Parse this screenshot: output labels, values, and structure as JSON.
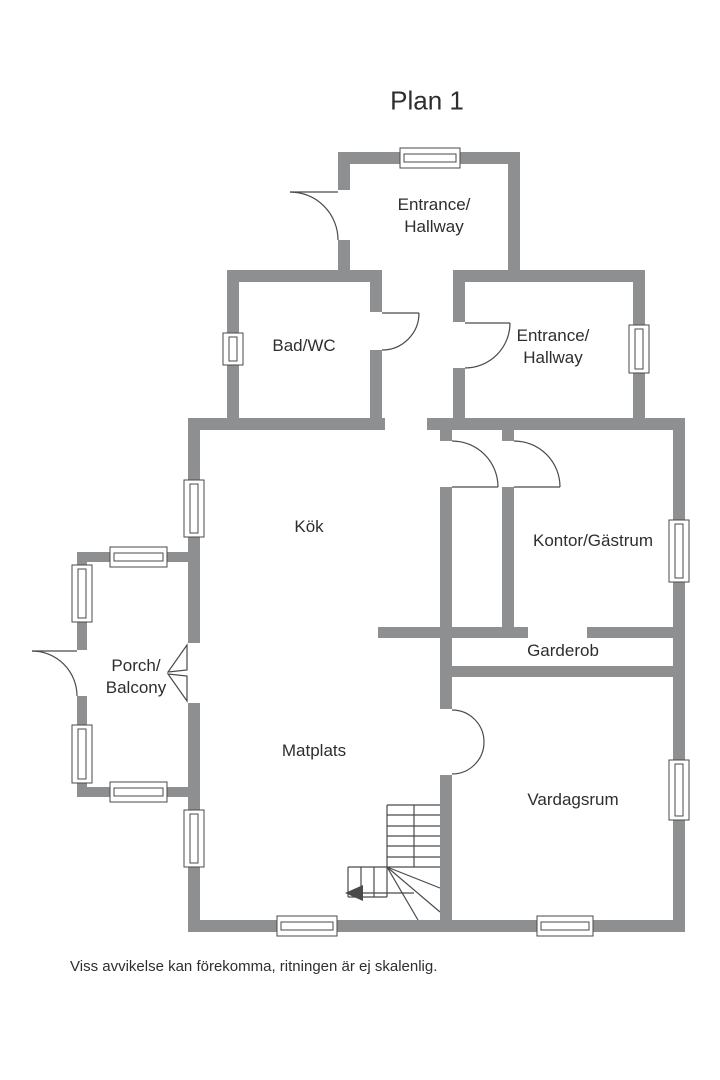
{
  "title": "Plan 1",
  "caption": "Viss avvikelse kan förekomma, ritningen är ej skalenlig.",
  "colors": {
    "wall": "#8d8f91",
    "line": "#4a4a4a",
    "text": "#2e2e2e",
    "background": "#ffffff"
  },
  "rooms": {
    "entrance_top": {
      "line1": "Entrance/",
      "line2": "Hallway"
    },
    "bad_wc": {
      "name": "Bad/WC"
    },
    "entrance_mid": {
      "line1": "Entrance/",
      "line2": "Hallway"
    },
    "kok": {
      "name": "Kök"
    },
    "kontor_gastrum": {
      "name": "Kontor/Gästrum"
    },
    "porch_balcony": {
      "line1": "Porch/",
      "line2": "Balcony"
    },
    "garderob": {
      "name": "Garderob"
    },
    "matplats": {
      "name": "Matplats"
    },
    "vardagsrum": {
      "name": "Vardagsrum"
    }
  }
}
